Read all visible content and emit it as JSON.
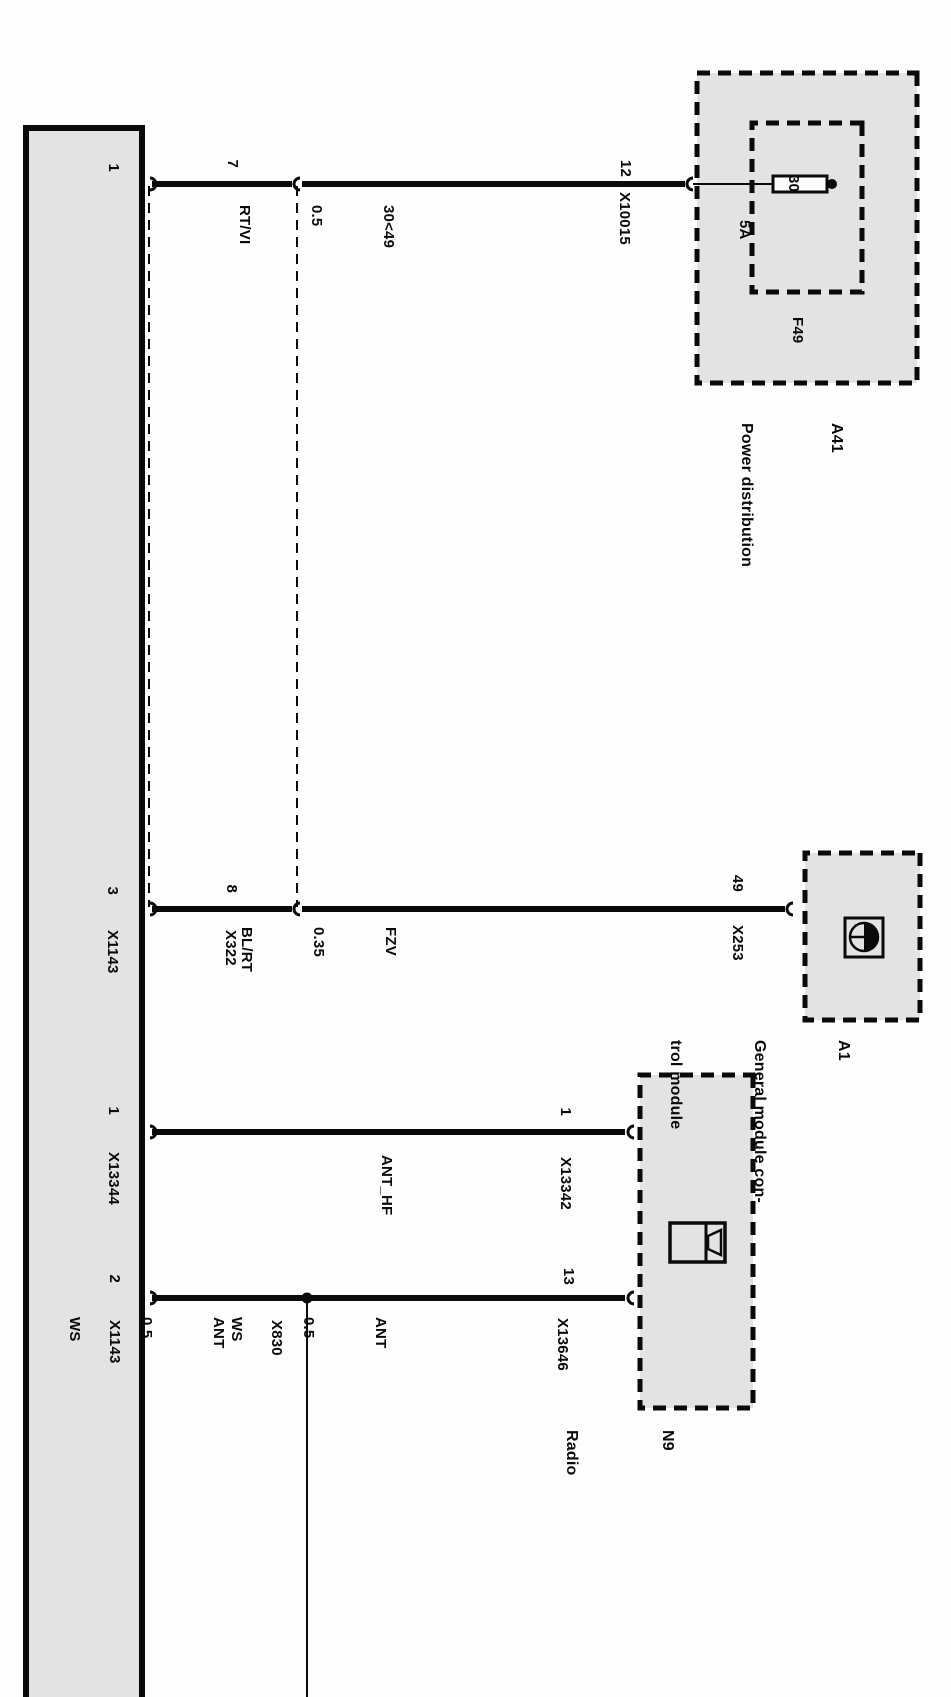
{
  "diagram_type": "automotive wiring diagram (rotated scan)",
  "colors": {
    "box_fill": "#e3e3e3",
    "line": "#0a0a0a",
    "background": "#ffffff"
  },
  "components": {
    "power_distribution": {
      "id": "A41",
      "name": "Power distribution",
      "connector": "X10015",
      "pin": "12",
      "fuse": {
        "id": "F49",
        "rating": "5A",
        "terminal": "30"
      }
    },
    "general_control_module": {
      "id": "A1",
      "name_line1": "General module con-",
      "name_line2": "trol module",
      "connector": "X253",
      "pin": "49"
    },
    "radio": {
      "id": "N9",
      "name": "Radio",
      "antenna_connector": "X13342",
      "antenna_pin": "1",
      "supply_connector": "X13646",
      "supply_pin": "13"
    }
  },
  "wires": [
    {
      "circuit": "30<49",
      "gauge": "0.5",
      "color": "RT/VI",
      "bar_pin": "1",
      "inline_pin": "7"
    },
    {
      "circuit": "FZV",
      "gauge": "0.35",
      "color": "BL/RT",
      "bar_pin": "3",
      "bar_connector": "X1143",
      "inline_pin": "8",
      "inline_connector": "X322"
    },
    {
      "circuit": "ANT_HF",
      "bar_pin": "1",
      "bar_connector": "X13344",
      "module_pin": "1"
    },
    {
      "circuit": "ANT",
      "gauge": "0.5",
      "color": "WS",
      "bar_pin": "2",
      "bar_connector": "X1143",
      "junction": "X830",
      "module_side": {
        "circuit": "ANT",
        "gauge": "0.5",
        "color": "WS"
      }
    }
  ]
}
